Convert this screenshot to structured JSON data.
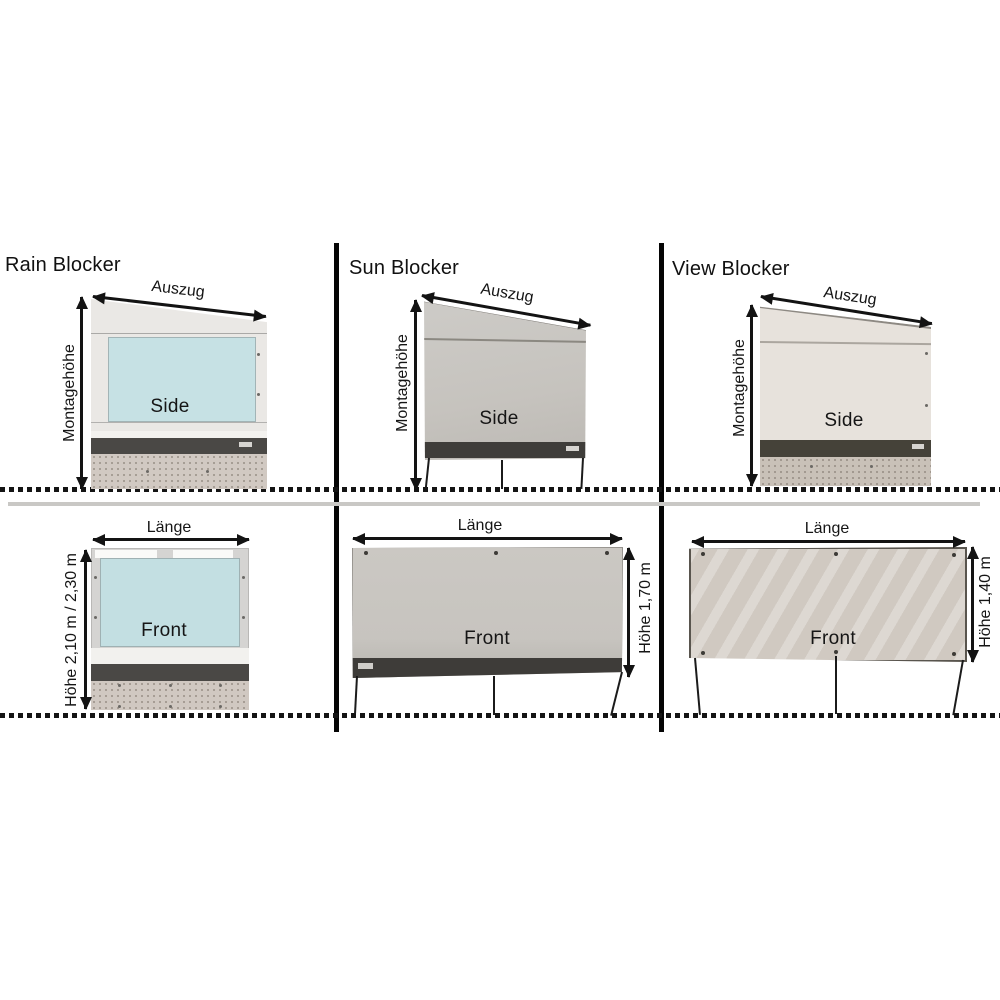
{
  "page": {
    "background": "#ffffff"
  },
  "sections": [
    {
      "title": "Rain Blocker",
      "side_view": {
        "extension_label": "Auszug",
        "mounting_height_label": "Montagehöhe",
        "caption": "Side"
      },
      "front_view": {
        "length_label": "Länge",
        "height_label": "Höhe 2,10 m / 2,30 m",
        "caption": "Front"
      },
      "panel_color": "#c6e1e4"
    },
    {
      "title": "Sun Blocker",
      "side_view": {
        "extension_label": "Auszug",
        "mounting_height_label": "Montagehöhe",
        "caption": "Side"
      },
      "front_view": {
        "length_label": "Länge",
        "height_label": "Höhe 1,70 m",
        "caption": "Front"
      },
      "panel_color": "#c8c5c0"
    },
    {
      "title": "View Blocker",
      "side_view": {
        "extension_label": "Auszug",
        "mounting_height_label": "Montagehöhe",
        "caption": "Side"
      },
      "front_view": {
        "length_label": "Länge",
        "height_label": "Höhe 1,40 m",
        "caption": "Front"
      },
      "panel_color": "#d0c9c1"
    }
  ],
  "colors": {
    "divider": "#050505",
    "dotted_line": "#141414",
    "ground_separator": "#c9c8c5",
    "dark_rail": "#45433f",
    "rain_window_blue": "#c6e1e4",
    "sun_canvas_gray": "#c8c5c0",
    "view_canvas_beige": "#d0c9c1",
    "skirt_beige": "#d0c8c1"
  }
}
